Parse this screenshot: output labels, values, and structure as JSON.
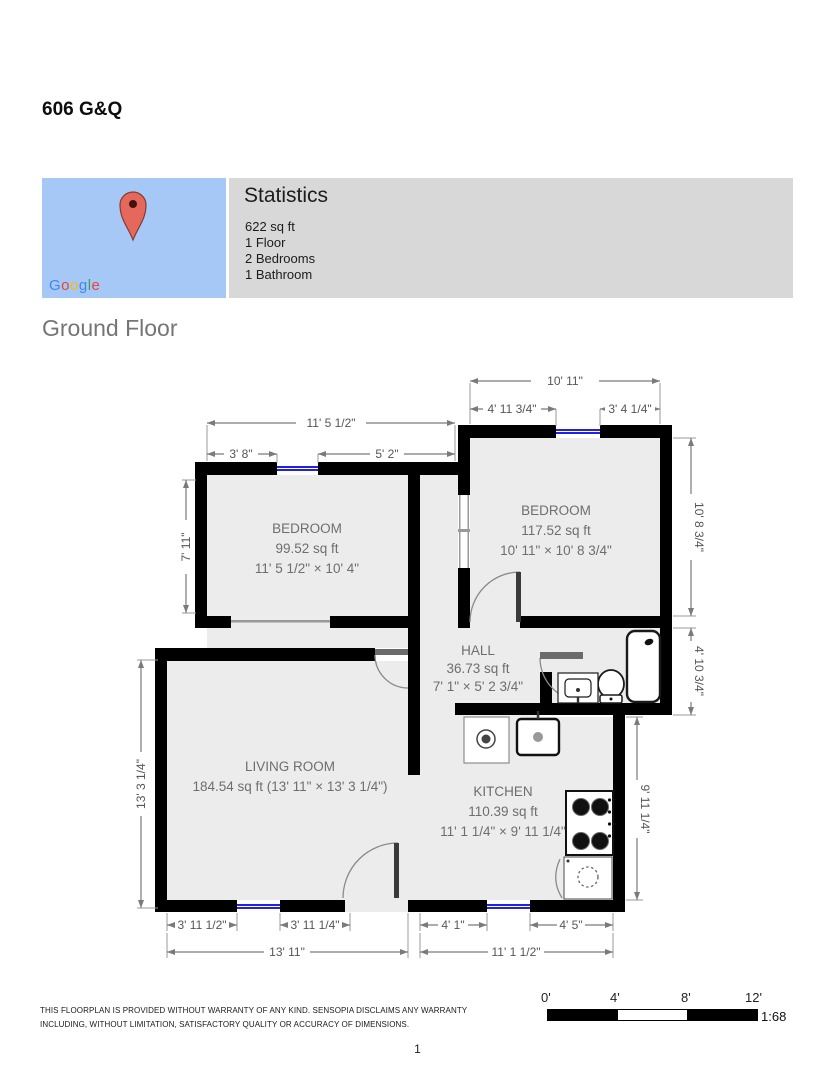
{
  "page": {
    "title": "606 G&Q",
    "floor_heading": "Ground Floor",
    "page_number": "1",
    "disclaimer": [
      "THIS FLOORPLAN IS PROVIDED WITHOUT WARRANTY OF ANY KIND. SENSOPIA DISCLAIMS ANY WARRANTY",
      "INCLUDING, WITHOUT LIMITATION, SATISFACTORY QUALITY OR ACCURACY OF DIMENSIONS."
    ]
  },
  "statistics": {
    "heading": "Statistics",
    "area": "622 sq ft",
    "floors": "1 Floor",
    "bedrooms": "2 Bedrooms",
    "bathrooms": "1 Bathroom"
  },
  "map": {
    "letters": [
      "G",
      "o",
      "o",
      "g",
      "l",
      "e"
    ],
    "letter_colors": [
      "#4285F4",
      "#EA4335",
      "#FBBC05",
      "#4285F4",
      "#34A853",
      "#EA4335"
    ],
    "bg_color": "#a5c8f6",
    "pin_color": "#e4695c"
  },
  "rooms": {
    "bedroom_left": {
      "name": "BEDROOM",
      "area": "99.52 sq ft",
      "dims": "11' 5 1/2\" × 10' 4\""
    },
    "bedroom_right": {
      "name": "BEDROOM",
      "area": "117.52 sq ft",
      "dims": "10' 11\" × 10' 8 3/4\""
    },
    "hall": {
      "name": "HALL",
      "area": "36.73 sq ft",
      "dims": "7' 1\" × 5' 2 3/4\""
    },
    "living_room": {
      "name": "LIVING ROOM",
      "area_dims": "184.54 sq ft (13' 11\" × 13' 3 1/4\")"
    },
    "kitchen": {
      "name": "KITCHEN",
      "area": "110.39 sq ft",
      "dims": "11' 1 1/4\" × 9' 11 1/4\""
    }
  },
  "dimensions": {
    "rb_width": "10' 11\"",
    "rb_left_seg": "4' 11 3/4\"",
    "rb_right_seg": "3' 4 1/4\"",
    "lb_width": "11' 5 1/2\"",
    "lb_left_seg": "3' 8\"",
    "lb_right_seg": "5' 2\"",
    "lb_height": "7' 11\"",
    "living_height": "13' 3 1/4\"",
    "rb_height": "10' 8 3/4\"",
    "bath_height": "4' 10 3/4\"",
    "kitchen_height": "9' 11 1/4\"",
    "living_bottom_left": "3' 11 1/2\"",
    "living_bottom_right": "3' 11 1/4\"",
    "living_width": "13' 11\"",
    "kitchen_bottom_left": "4' 1\"",
    "kitchen_bottom_right": "4' 5\"",
    "kitchen_width": "11' 1 1/2\""
  },
  "scale_bar": {
    "labels": [
      "0'",
      "4'",
      "8'",
      "12'"
    ],
    "ratio": "1:68"
  }
}
